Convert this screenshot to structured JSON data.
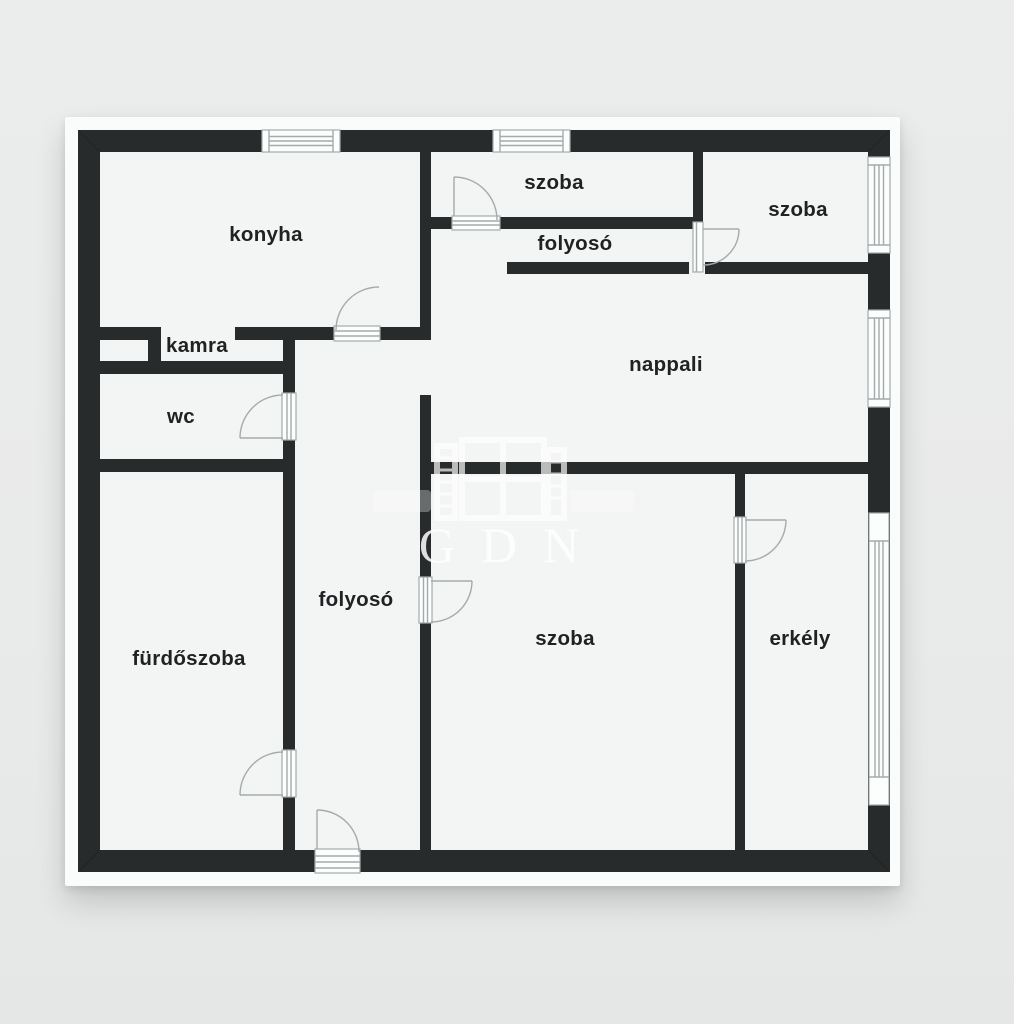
{
  "page": {
    "background_color": "#e9eaea"
  },
  "sheet": {
    "paper_color": "#fafbfb",
    "floor_color": "#f3f4f4",
    "wall_color": "#282b2c",
    "fixture_line_color": "#a4abab",
    "label_color": "#1f2122"
  },
  "watermark": {
    "text": "GDN",
    "color": "#ffffff"
  },
  "rooms": [
    {
      "id": "konyha",
      "label": "konyha"
    },
    {
      "id": "szoba-top",
      "label": "szoba"
    },
    {
      "id": "folyoso-upper",
      "label": "folyosó"
    },
    {
      "id": "szoba-top-right",
      "label": "szoba"
    },
    {
      "id": "nappali",
      "label": "nappali"
    },
    {
      "id": "kamra",
      "label": "kamra"
    },
    {
      "id": "wc",
      "label": "wc"
    },
    {
      "id": "folyoso-lower",
      "label": "folyosó"
    },
    {
      "id": "furdoszoba",
      "label": "fürdőszoba"
    },
    {
      "id": "szoba-bottom",
      "label": "szoba"
    },
    {
      "id": "erkely",
      "label": "erkély"
    }
  ]
}
